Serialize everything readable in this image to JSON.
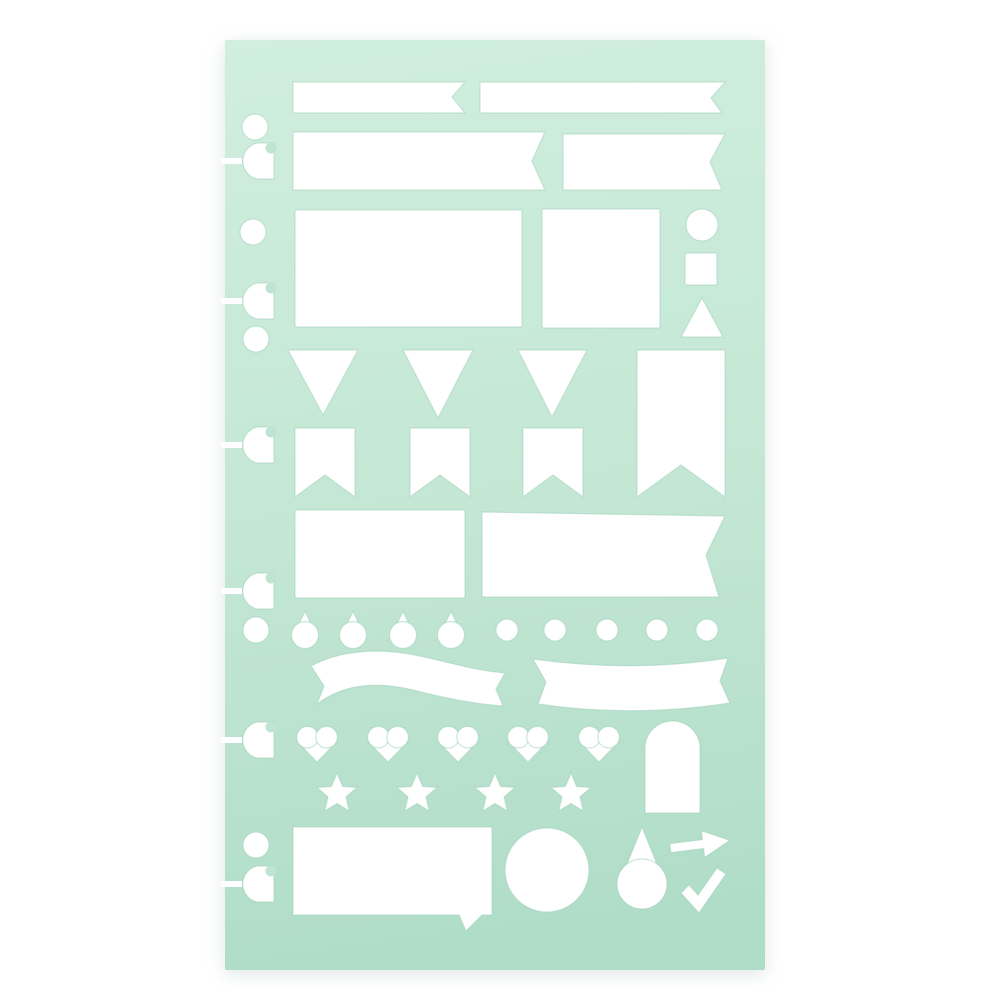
{
  "colors": {
    "background": "#ffffff",
    "stencil_top": "#d1eede",
    "stencil_mid": "#c3e7d4",
    "stencil_bottom": "#b0ddc8",
    "cutout": "#ffffff",
    "cutout_edge": "#9ccfba",
    "slot_bite": "#bfe4d1"
  },
  "stencil": {
    "x": 225,
    "y": 40,
    "width": 540,
    "height": 930,
    "corner_radius": 2
  },
  "slot_style": {
    "body_right_x": 274,
    "flat_half_height": 18,
    "round_radius": 18.5,
    "slit_x": 221,
    "slit_width": 21,
    "slit_height": 6,
    "bite_cx": 271,
    "bite_dy": -13,
    "bite_r": 5.5
  },
  "shapes": [
    {
      "name": "binder-hole-1",
      "kind": "circle",
      "cx": 255,
      "cy": 127,
      "r": 13
    },
    {
      "name": "binder-slot-1",
      "kind": "slot",
      "cy": 161
    },
    {
      "name": "binder-hole-2",
      "kind": "circle",
      "cx": 253,
      "cy": 232,
      "r": 13
    },
    {
      "name": "binder-slot-2",
      "kind": "slot",
      "cy": 301
    },
    {
      "name": "binder-hole-3",
      "kind": "circle",
      "cx": 256,
      "cy": 339,
      "r": 13
    },
    {
      "name": "binder-slot-3",
      "kind": "slot",
      "cy": 445
    },
    {
      "name": "binder-slot-4",
      "kind": "slot",
      "cy": 591
    },
    {
      "name": "binder-hole-4",
      "kind": "circle",
      "cx": 256,
      "cy": 630,
      "r": 13
    },
    {
      "name": "binder-slot-5",
      "kind": "slot",
      "cy": 740
    },
    {
      "name": "binder-hole-5",
      "kind": "circle",
      "cx": 256,
      "cy": 845,
      "r": 13
    },
    {
      "name": "binder-slot-6",
      "kind": "slot",
      "cy": 884
    },
    {
      "name": "banner-small-notched",
      "kind": "polygon",
      "points": [
        [
          293,
          82
        ],
        [
          465,
          82
        ],
        [
          452,
          97
        ],
        [
          465,
          113
        ],
        [
          293,
          113
        ]
      ]
    },
    {
      "name": "banner-small-swallowtail",
      "kind": "polygon",
      "points": [
        [
          480,
          82
        ],
        [
          725,
          82
        ],
        [
          711,
          98
        ],
        [
          722,
          113
        ],
        [
          480,
          113
        ]
      ]
    },
    {
      "name": "banner-medium-notched",
      "kind": "polygon",
      "points": [
        [
          293,
          132
        ],
        [
          545,
          132
        ],
        [
          532,
          161
        ],
        [
          545,
          190
        ],
        [
          293,
          190
        ]
      ]
    },
    {
      "name": "banner-medium-swallowtail",
      "kind": "polygon",
      "points": [
        [
          563,
          134
        ],
        [
          725,
          134
        ],
        [
          710,
          162
        ],
        [
          722,
          190
        ],
        [
          563,
          190
        ]
      ]
    },
    {
      "name": "rectangle-large",
      "kind": "rect",
      "x": 295,
      "y": 210,
      "w": 227,
      "h": 117
    },
    {
      "name": "rectangle-square",
      "kind": "rect",
      "x": 542,
      "y": 209,
      "w": 118,
      "h": 119
    },
    {
      "name": "circle-small",
      "kind": "circle",
      "cx": 702,
      "cy": 225,
      "r": 16
    },
    {
      "name": "square-small",
      "kind": "rect",
      "x": 685,
      "y": 253,
      "w": 32,
      "h": 32
    },
    {
      "name": "triangle-up",
      "kind": "polygon",
      "points": [
        [
          702,
          298
        ],
        [
          723,
          337
        ],
        [
          681,
          337
        ]
      ]
    },
    {
      "name": "pennant-triangle-1",
      "kind": "polygon",
      "points": [
        [
          288,
          350
        ],
        [
          358,
          350
        ],
        [
          323,
          415
        ]
      ]
    },
    {
      "name": "pennant-triangle-2",
      "kind": "polygon",
      "points": [
        [
          403,
          350
        ],
        [
          473,
          350
        ],
        [
          438,
          418
        ]
      ]
    },
    {
      "name": "pennant-triangle-3",
      "kind": "polygon",
      "points": [
        [
          518,
          350
        ],
        [
          587,
          350
        ],
        [
          552,
          417
        ]
      ]
    },
    {
      "name": "banner-vertical-swallowtail",
      "kind": "polygon",
      "points": [
        [
          637,
          350
        ],
        [
          725,
          350
        ],
        [
          725,
          497
        ],
        [
          681,
          465
        ],
        [
          637,
          497
        ]
      ]
    },
    {
      "name": "pennant-flag-1",
      "kind": "polygon",
      "points": [
        [
          295,
          428
        ],
        [
          355,
          428
        ],
        [
          355,
          497
        ],
        [
          325,
          475
        ],
        [
          295,
          497
        ]
      ]
    },
    {
      "name": "pennant-flag-2",
      "kind": "polygon",
      "points": [
        [
          410,
          428
        ],
        [
          470,
          428
        ],
        [
          470,
          497
        ],
        [
          440,
          475
        ],
        [
          410,
          497
        ]
      ]
    },
    {
      "name": "pennant-flag-3",
      "kind": "polygon",
      "points": [
        [
          523,
          428
        ],
        [
          583,
          428
        ],
        [
          583,
          497
        ],
        [
          553,
          475
        ],
        [
          523,
          497
        ]
      ]
    },
    {
      "name": "rectangle-medium",
      "kind": "rect",
      "x": 295,
      "y": 510,
      "w": 170,
      "h": 88
    },
    {
      "name": "banner-large-swallowtail",
      "kind": "polygon",
      "points": [
        [
          482,
          512
        ],
        [
          725,
          516
        ],
        [
          706,
          555
        ],
        [
          719,
          597
        ],
        [
          482,
          597
        ]
      ]
    },
    {
      "name": "teardrop-small-1",
      "kind": "drop",
      "cx": 305,
      "cy": 630,
      "w": 27,
      "h": 37
    },
    {
      "name": "teardrop-small-2",
      "kind": "drop",
      "cx": 353,
      "cy": 630,
      "w": 27,
      "h": 37
    },
    {
      "name": "teardrop-small-3",
      "kind": "drop",
      "cx": 403,
      "cy": 630,
      "w": 27,
      "h": 37
    },
    {
      "name": "teardrop-small-4",
      "kind": "drop",
      "cx": 451,
      "cy": 630,
      "w": 27,
      "h": 37
    },
    {
      "name": "dot-1",
      "kind": "circle",
      "cx": 507,
      "cy": 630,
      "r": 11
    },
    {
      "name": "dot-2",
      "kind": "circle",
      "cx": 555,
      "cy": 630,
      "r": 11
    },
    {
      "name": "dot-3",
      "kind": "circle",
      "cx": 607,
      "cy": 630,
      "r": 11
    },
    {
      "name": "dot-4",
      "kind": "circle",
      "cx": 657,
      "cy": 630,
      "r": 11
    },
    {
      "name": "dot-5",
      "kind": "circle",
      "cx": 707,
      "cy": 630,
      "r": 11
    },
    {
      "name": "ribbon-wave",
      "kind": "path",
      "d": "M 311 666 C 342 649 383 648 420 656 C 452 663 478 671 505 673 L 496 689 L 503 706 C 473 704 444 698 413 690 C 376 681 344 684 317 704 L 324 686 Z"
    },
    {
      "name": "ribbon-arc",
      "kind": "path",
      "d": "M 533 659 Q 633 673 728 658 L 720 681 L 730 703 Q 633 718 538 704 L 546 682 Z"
    },
    {
      "name": "heart-1",
      "kind": "heart",
      "cx": 317,
      "cy": 744,
      "w": 40
    },
    {
      "name": "heart-2",
      "kind": "heart",
      "cx": 388,
      "cy": 744,
      "w": 40
    },
    {
      "name": "heart-3",
      "kind": "heart",
      "cx": 458,
      "cy": 744,
      "w": 40
    },
    {
      "name": "heart-4",
      "kind": "heart",
      "cx": 528,
      "cy": 744,
      "w": 40
    },
    {
      "name": "heart-5",
      "kind": "heart",
      "cx": 599,
      "cy": 744,
      "w": 40
    },
    {
      "name": "arch-rounded-top",
      "kind": "path",
      "d": "M 645 813 L 645 748 A 27.5 27 0 0 1 700 748 L 700 813 Z"
    },
    {
      "name": "star-1",
      "kind": "star",
      "cx": 337,
      "cy": 794,
      "r": 21
    },
    {
      "name": "star-2",
      "kind": "star",
      "cx": 417,
      "cy": 794,
      "r": 21
    },
    {
      "name": "star-3",
      "kind": "star",
      "cx": 495,
      "cy": 794,
      "r": 21
    },
    {
      "name": "star-4",
      "kind": "star",
      "cx": 571,
      "cy": 794,
      "r": 21
    },
    {
      "name": "speech-bubble",
      "kind": "path",
      "d": "M 293 827 L 492 827 L 492 915 L 482 915 L 466 931 L 459 915 L 293 915 Z"
    },
    {
      "name": "circle-large",
      "kind": "circle",
      "cx": 547,
      "cy": 870,
      "r": 42
    },
    {
      "name": "teardrop-large",
      "kind": "drop",
      "cx": 642,
      "cy": 868,
      "w": 50,
      "h": 82
    },
    {
      "name": "arrow-right",
      "kind": "polygon",
      "transform": "rotate(-7 700 844)",
      "points": [
        [
          670,
          840
        ],
        [
          703,
          840
        ],
        [
          703,
          831
        ],
        [
          730,
          844
        ],
        [
          703,
          858
        ],
        [
          703,
          849
        ],
        [
          670,
          849
        ]
      ]
    },
    {
      "name": "checkmark",
      "kind": "polygon",
      "points": [
        [
          681,
          893
        ],
        [
          689,
          885
        ],
        [
          698,
          895
        ],
        [
          717,
          868
        ],
        [
          726,
          874
        ],
        [
          699,
          913
        ]
      ]
    }
  ]
}
